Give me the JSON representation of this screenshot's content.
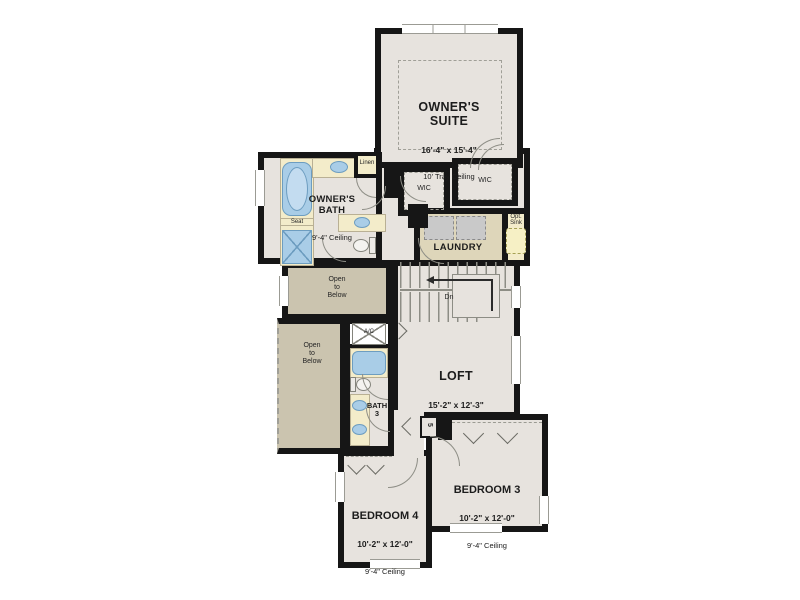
{
  "plan": {
    "colors": {
      "wall": "#161616",
      "floor": "#e7e3de",
      "open_below_floor": "#cbc4af",
      "laundry_floor": "#ded6ba",
      "counter": "#f3ecca",
      "fixture_blue": "#a9cde7",
      "fixture_outline": "#6d9dc0"
    },
    "rooms": {
      "owners_suite": {
        "label": "OWNER'S\nSUITE",
        "dims": "16'-4\" x 15'-4\"",
        "ceiling": "10' Tray Ceiling"
      },
      "owners_bath": {
        "label": "OWNER'S\nBATH",
        "ceiling": "9'-4\" Ceiling"
      },
      "wic_left": {
        "label": "WIC"
      },
      "wic_right": {
        "label": "WIC"
      },
      "laundry": {
        "label": "LAUNDRY"
      },
      "opt_sink": {
        "label": "Opt.\nSink"
      },
      "open_below_upper": {
        "label": "Open\nto\nBelow"
      },
      "open_below_lower": {
        "label": "Open\nto\nBelow"
      },
      "loft": {
        "label": "LOFT",
        "dims": "15'-2\" x 12'-3\""
      },
      "bath3": {
        "label": "BATH\n3"
      },
      "bedroom3": {
        "label": "BEDROOM 3",
        "dims": "10'-2\" x 12'-0\"",
        "ceiling": "9'-4\" Ceiling"
      },
      "bedroom4": {
        "label": "BEDROOM 4",
        "dims": "10'-2\" x 12'-0\"",
        "ceiling": "9'-4\" Ceiling"
      }
    },
    "labels": {
      "seat": "Seat",
      "linen": "Linen",
      "ac": "A/C",
      "dn": "Dn",
      "shelf_count": "5"
    }
  }
}
